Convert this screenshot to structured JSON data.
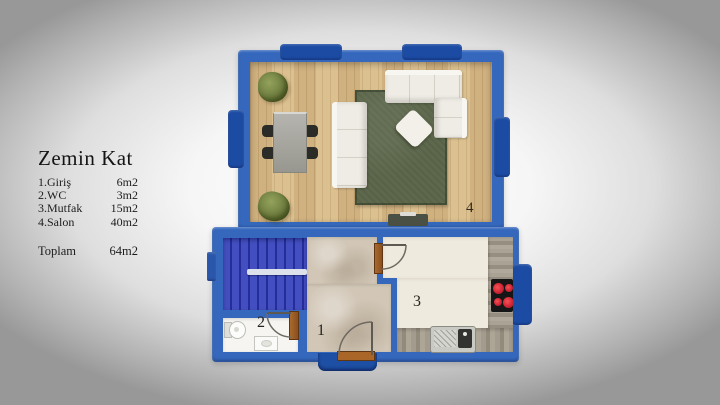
{
  "legend": {
    "title": "Zemin Kat",
    "rooms": [
      {
        "label": "1.Giriş",
        "area": "6m2"
      },
      {
        "label": "2.WC",
        "area": "3m2"
      },
      {
        "label": "3.Mutfak",
        "area": "15m2"
      },
      {
        "label": "4.Salon",
        "area": "40m2"
      }
    ],
    "total_label": "Toplam",
    "total_area": "64m2"
  },
  "plan": {
    "room_numbers": {
      "entrance": "1",
      "wc": "2",
      "kitchen": "3",
      "salon": "4"
    },
    "colors": {
      "wall": "#3568bd",
      "window": "#1b4ba3",
      "stairs": "#3340bb",
      "wood_floor": "#d8bd8e",
      "rug": "#5d684c",
      "sofa": "#eeece4",
      "hall_floor": "#d2c7b7",
      "kitchen_floor": "#efeade",
      "wc_floor": "#f6f5f1",
      "counter": "#a39b8d",
      "burner": "#d92a3a",
      "door_trim": "#a96628"
    }
  }
}
